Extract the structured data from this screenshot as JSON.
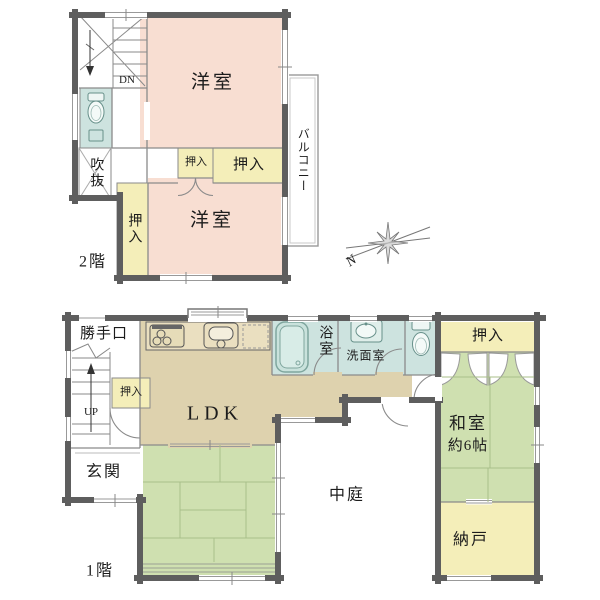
{
  "floor2": {
    "floor_label": "2階",
    "room_yoshitsu_upper": "洋室",
    "room_yoshitsu_lower": "洋室",
    "balcony": "バルコニー",
    "fukinuke": "吹抜",
    "oshiire_left": "押入",
    "oshiire_small": "押入",
    "oshiire_wide": "押入",
    "stairs_dn": "DN"
  },
  "floor1": {
    "floor_label": "1階",
    "katteguchi": "勝手口",
    "ldk": "LDK",
    "bathroom": "浴室",
    "washroom": "洗面室",
    "oshiire_hall": "押入",
    "oshiire_washitsu": "押入",
    "washitsu_name": "和室",
    "washitsu_size": "約6帖",
    "nando": "納戸",
    "genkan": "玄関",
    "nakaniwa": "中庭",
    "stairs_up": "UP"
  },
  "compass": {
    "north": "N"
  },
  "colors": {
    "room_pink": "#f8ded2",
    "room_yellow": "#f4eeb9",
    "room_green": "#cfe0b0",
    "room_tan": "#ded2ae",
    "room_blue": "#cde3df",
    "wall": "#5e5e5e",
    "thin_line": "#8a8a8a"
  }
}
